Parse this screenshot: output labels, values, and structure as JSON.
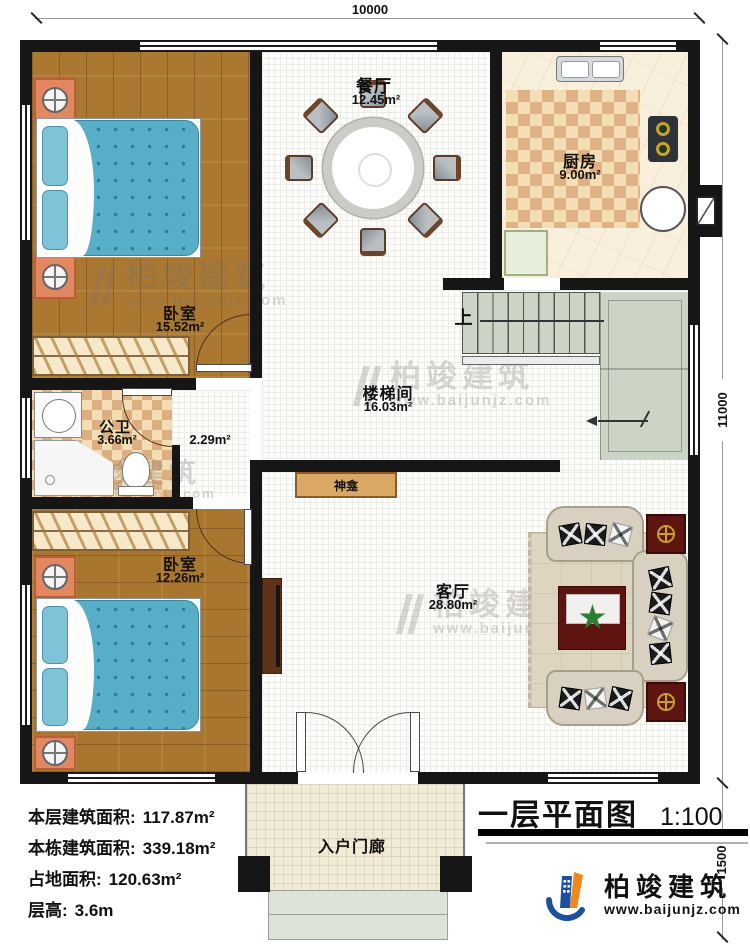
{
  "plan": {
    "title": "一层平面图",
    "scale": "1:100",
    "dims": {
      "width": "10000",
      "height": "11000",
      "porch": "1500"
    },
    "rooms": {
      "dining": {
        "name": "餐厅",
        "area": "12.45m²"
      },
      "kitchen": {
        "name": "厨房",
        "area": "9.00m²"
      },
      "bedroom1": {
        "name": "卧室",
        "area": "15.52m²"
      },
      "stairhall": {
        "name": "楼梯间",
        "area": "16.03m²"
      },
      "bathroom": {
        "name": "公卫",
        "area": "3.66m²"
      },
      "hallway": {
        "area": "2.29m²"
      },
      "bedroom2": {
        "name": "卧室",
        "area": "12.26m²"
      },
      "living": {
        "name": "客厅",
        "area": "28.80m²"
      },
      "porch": {
        "name": "入户门廊"
      },
      "shrine": {
        "name": "神龛"
      },
      "stairs": {
        "up": "上"
      }
    },
    "stats": {
      "lines": [
        {
          "label": "本层建筑面积:",
          "value": "117.87m²"
        },
        {
          "label": "本栋建筑面积:",
          "value": "339.18m²"
        },
        {
          "label": "占地面积:",
          "value": "120.63m²"
        },
        {
          "label": "层高:",
          "value": "3.6m"
        }
      ]
    },
    "brand": {
      "name": "柏竣建筑",
      "url": "www.baijunjz.com"
    },
    "watermark": {
      "name": "柏竣建筑",
      "url": "www.baijunjz.com"
    },
    "colors": {
      "wall": "#161616",
      "bed": "#58aec7",
      "checker": "#dfb184",
      "stair": "#ccd4c6",
      "accent_red": "#5e1511",
      "logo_blue": "#1c4f9c",
      "logo_orange": "#f0871c"
    }
  }
}
